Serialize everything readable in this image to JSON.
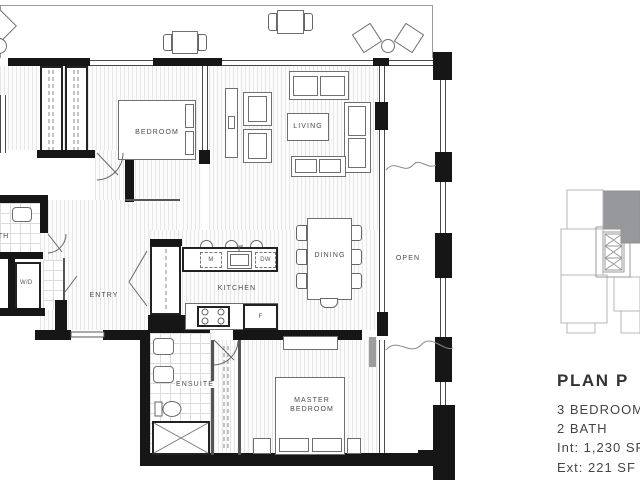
{
  "floorplan": {
    "rooms": {
      "bedroom": {
        "label": "BEDROOM"
      },
      "living": {
        "label": "LIVING"
      },
      "dining": {
        "label": "DINING"
      },
      "kitchen": {
        "label": "KITCHEN"
      },
      "entry": {
        "label": "ENTRY"
      },
      "bath": {
        "label": "BATH"
      },
      "ensuite": {
        "label": "ENSUITE"
      },
      "master_bedroom": {
        "label": "MASTER BEDROOM"
      },
      "open": {
        "label": "OPEN"
      }
    },
    "fixtures": {
      "microwave": "M",
      "dishwasher": "DW",
      "fridge": "F",
      "washer_dryer": "W/D"
    }
  },
  "info_panel": {
    "title": "PLAN P",
    "specs": [
      "3 BEDROOM",
      "2 BATH",
      "Int: 1,230 SF",
      "Ext: 221 SF"
    ]
  },
  "colors": {
    "wall": "#161616",
    "line": "#555555",
    "keyplan_unit_fill": "#97989b",
    "text": "#454545"
  }
}
